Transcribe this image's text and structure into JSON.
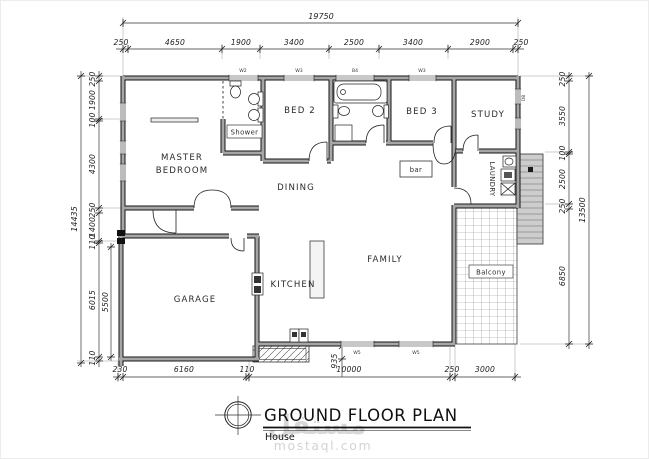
{
  "drawing": {
    "title": "GROUND FLOOR PLAN",
    "subtitle": "House"
  },
  "watermark": {
    "arabic": "مستقل",
    "domain": "mostaql.com"
  },
  "rooms": {
    "master_line1": "MASTER",
    "master_line2": "BEDROOM",
    "bed2": "BED 2",
    "bed3": "BED 3",
    "study": "STUDY",
    "dining": "DINING",
    "family": "FAMILY",
    "kitchen": "KITCHEN",
    "garage": "GARAGE",
    "laundry": "LAUNDRY",
    "shower": "Shower",
    "bar": "bar",
    "balcony": "Balcony"
  },
  "dims": {
    "top_total": "19750",
    "top": [
      "250",
      "4650",
      "1900",
      "3400",
      "2500",
      "3400",
      "2900",
      "250"
    ],
    "left_total": "14435",
    "left": [
      "250",
      "1900",
      "100",
      "4300",
      "250",
      "1400",
      "110",
      "6015",
      "110"
    ],
    "left_inner": "5500",
    "right_total": "13500",
    "right": [
      "250",
      "3550",
      "100",
      "2500",
      "250",
      "6850"
    ],
    "bottom": [
      "230",
      "6160",
      "110",
      "10000",
      "250",
      "3000"
    ],
    "step_height": "935"
  },
  "window_tags": {
    "t1": "W2",
    "t2": "W3",
    "t3": "B4",
    "t4": "W3",
    "b1": "W5",
    "b2": "W5",
    "r1": "D8"
  },
  "colors": {
    "wall_core": "#a6a6a6",
    "wall_edge": "#141414",
    "line": "#222222",
    "watermark": "#d8d8d8"
  }
}
